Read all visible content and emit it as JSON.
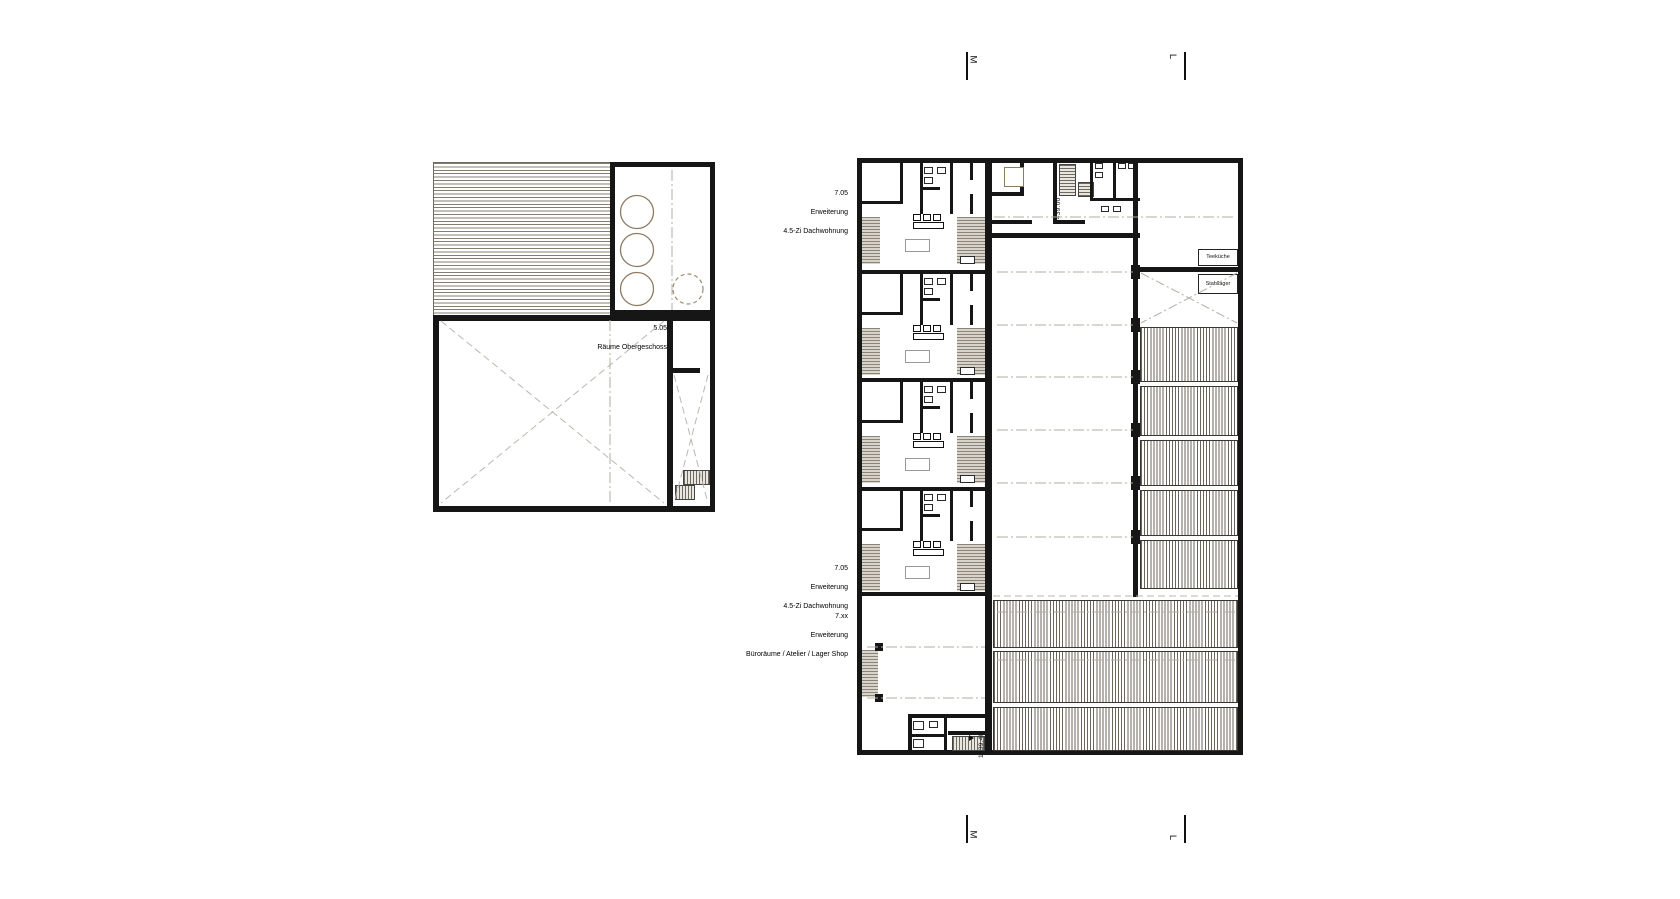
{
  "sheet": {
    "background": "#ffffff",
    "ink": "#161616",
    "tan_accent": "#8d7b62",
    "centerline_color": "#b3ac9f"
  },
  "left_plan": {
    "code": "5.05",
    "name": "Räume Obergeschoss"
  },
  "right_plan": {
    "label_top": {
      "code": "7.05",
      "line2": "Erweiterung",
      "line3": "4.5-Zi Dachwohnung"
    },
    "label_mid": {
      "code": "7.05",
      "line2": "Erweiterung",
      "line3": "4.5-Zi Dachwohnung"
    },
    "label_bottom": {
      "code": "7.xx",
      "line2": "Erweiterung",
      "line3": "Büroräume / Atelier / Lager Shop"
    },
    "elevation_top": "1439.00",
    "elevation_bottom": "1439.40",
    "room_teekueche": "Teeküche",
    "room_stahllager": "Stahllager"
  },
  "section_markers": {
    "m": "M",
    "l": "L"
  }
}
